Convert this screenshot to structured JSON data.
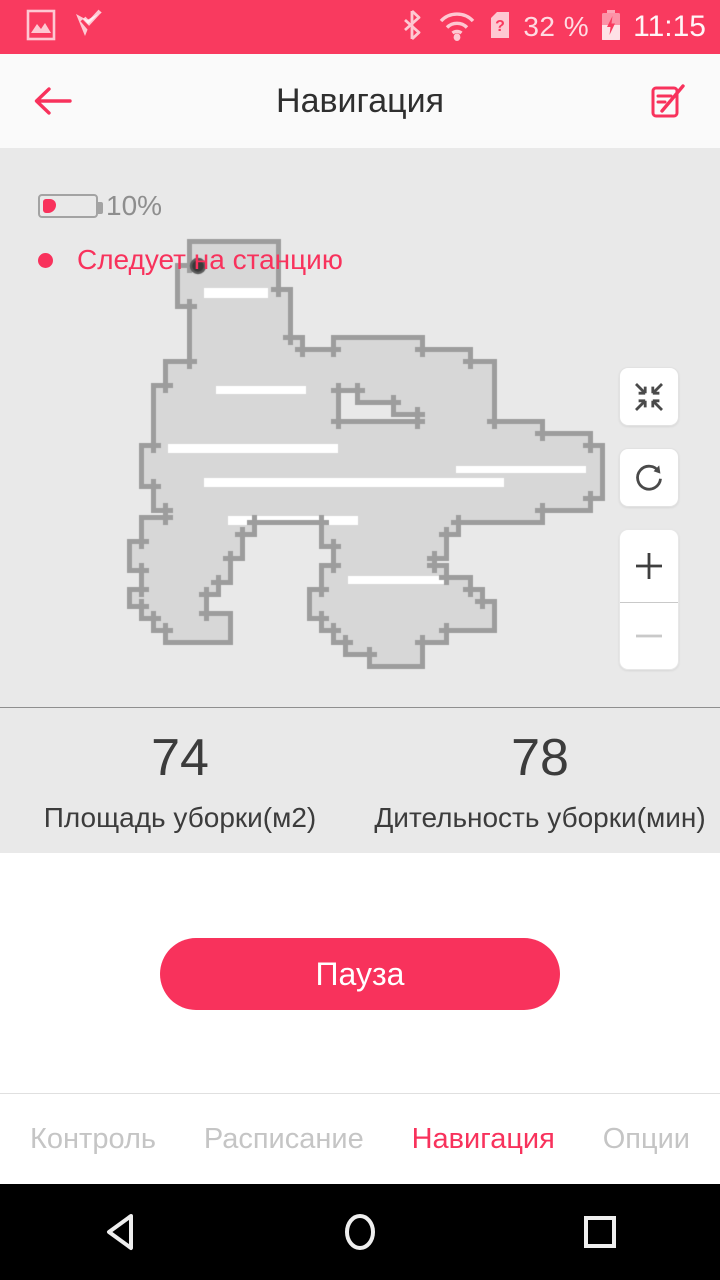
{
  "colors": {
    "accent": "#f8325c",
    "status_bar_bg": "#f93a5f",
    "map_bg": "#e9e9e9",
    "map_fill": "#d7d7d7",
    "map_border": "#9d9d9d",
    "map_streak": "#ffffff",
    "dock_dot": "#3a3a3a",
    "text_dark": "#3c3c3c",
    "tab_inactive": "#c5c5c5"
  },
  "status_bar": {
    "time": "11:15",
    "battery_text": "32 %",
    "sim_unknown_glyph": "?",
    "left_icons": [
      "screenshot-icon",
      "checkmark-app-icon"
    ],
    "right_icons": [
      "bluetooth-icon",
      "wifi-icon",
      "sim-unknown-icon",
      "battery-charging-icon"
    ]
  },
  "header": {
    "title": "Навигация",
    "icons": [
      "back-arrow-icon",
      "edit-map-icon"
    ]
  },
  "map": {
    "robot_battery_percent": "10%",
    "status_text": "Следует на станцию",
    "controls": [
      "center-map",
      "rotate-map",
      "zoom-in",
      "zoom-out"
    ],
    "canvas": {
      "cell": 12,
      "cols": 60,
      "rows": 46,
      "border_thickness": 5,
      "runs": [
        [
          8,
          16,
          22
        ],
        [
          9,
          16,
          22
        ],
        [
          10,
          15,
          22
        ],
        [
          11,
          15,
          22
        ],
        [
          12,
          15,
          23
        ],
        [
          13,
          16,
          23
        ],
        [
          14,
          16,
          23
        ],
        [
          15,
          16,
          23
        ],
        [
          16,
          16,
          24
        ],
        [
          16,
          28,
          34
        ],
        [
          17,
          16,
          38
        ],
        [
          18,
          14,
          40
        ],
        [
          19,
          14,
          40
        ],
        [
          20,
          13,
          27
        ],
        [
          20,
          30,
          40
        ],
        [
          21,
          13,
          27
        ],
        [
          21,
          33,
          40
        ],
        [
          22,
          13,
          27
        ],
        [
          22,
          35,
          40
        ],
        [
          23,
          13,
          44
        ],
        [
          24,
          13,
          48
        ],
        [
          25,
          12,
          49
        ],
        [
          26,
          12,
          49
        ],
        [
          27,
          12,
          49
        ],
        [
          28,
          13,
          49
        ],
        [
          29,
          13,
          48
        ],
        [
          30,
          14,
          44
        ],
        [
          31,
          12,
          20
        ],
        [
          31,
          27,
          37
        ],
        [
          32,
          12,
          19
        ],
        [
          32,
          27,
          36
        ],
        [
          33,
          11,
          19
        ],
        [
          33,
          28,
          36
        ],
        [
          34,
          11,
          18
        ],
        [
          34,
          28,
          35
        ],
        [
          35,
          12,
          18
        ],
        [
          35,
          27,
          36
        ],
        [
          36,
          12,
          17
        ],
        [
          36,
          27,
          38
        ],
        [
          37,
          11,
          16
        ],
        [
          37,
          26,
          39
        ],
        [
          38,
          12,
          16
        ],
        [
          38,
          26,
          40
        ],
        [
          39,
          13,
          18
        ],
        [
          39,
          27,
          40
        ],
        [
          40,
          14,
          18
        ],
        [
          40,
          28,
          36
        ],
        [
          41,
          29,
          34
        ],
        [
          42,
          31,
          34
        ]
      ],
      "streaks": [
        [
          168,
          296,
          170,
          9
        ],
        [
          204,
          330,
          300,
          9
        ],
        [
          456,
          318,
          130,
          7
        ],
        [
          228,
          368,
          130,
          9
        ],
        [
          204,
          140,
          64,
          10
        ],
        [
          348,
          428,
          96,
          8
        ],
        [
          216,
          238,
          90,
          8
        ]
      ],
      "dock": {
        "x": 198,
        "y": 118,
        "r": 7
      }
    }
  },
  "stats": [
    {
      "value": "74",
      "label": "Площадь уборки(м2)"
    },
    {
      "value": "78",
      "label": "Дительность уборки(мин)"
    }
  ],
  "primary_action": {
    "label": "Пауза"
  },
  "tabs": [
    {
      "label": "Контроль",
      "active": false
    },
    {
      "label": "Расписание",
      "active": false
    },
    {
      "label": "Навигация",
      "active": true
    },
    {
      "label": "Опции",
      "active": false
    }
  ],
  "android_nav": [
    "back",
    "home",
    "recents"
  ]
}
